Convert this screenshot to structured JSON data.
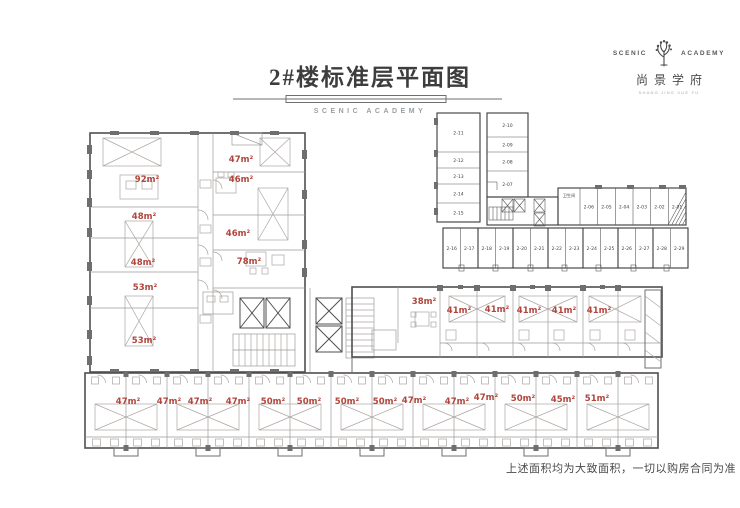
{
  "header": {
    "title": "2#楼标准层平面图",
    "subtitle": "SCENIC ACADEMY"
  },
  "logo": {
    "name_left": "SCENIC",
    "name_right": "ACADEMY",
    "icon": "tree-icon",
    "chinese_name": "尚景学府",
    "tagline": "SHANG JING XUE FU"
  },
  "plan": {
    "area_labels": [
      {
        "t": "92㎡",
        "x": 147,
        "y": 182
      },
      {
        "t": "47㎡",
        "x": 241,
        "y": 162
      },
      {
        "t": "46㎡",
        "x": 241,
        "y": 182
      },
      {
        "t": "48㎡",
        "x": 144,
        "y": 219
      },
      {
        "t": "46㎡",
        "x": 238,
        "y": 236
      },
      {
        "t": "48㎡",
        "x": 143,
        "y": 265
      },
      {
        "t": "78㎡",
        "x": 249,
        "y": 264
      },
      {
        "t": "53㎡",
        "x": 145,
        "y": 290
      },
      {
        "t": "53㎡",
        "x": 144,
        "y": 343
      },
      {
        "t": "38㎡",
        "x": 424,
        "y": 304
      },
      {
        "t": "41㎡",
        "x": 459,
        "y": 313
      },
      {
        "t": "41㎡",
        "x": 497,
        "y": 312
      },
      {
        "t": "41㎡",
        "x": 529,
        "y": 313
      },
      {
        "t": "41㎡",
        "x": 564,
        "y": 313
      },
      {
        "t": "41㎡",
        "x": 599,
        "y": 313
      },
      {
        "t": "47㎡",
        "x": 128,
        "y": 404
      },
      {
        "t": "47㎡",
        "x": 169,
        "y": 404
      },
      {
        "t": "47㎡",
        "x": 200,
        "y": 404
      },
      {
        "t": "47㎡",
        "x": 238,
        "y": 404
      },
      {
        "t": "50㎡",
        "x": 273,
        "y": 404
      },
      {
        "t": "50㎡",
        "x": 309,
        "y": 404
      },
      {
        "t": "50㎡",
        "x": 347,
        "y": 404
      },
      {
        "t": "50㎡",
        "x": 385,
        "y": 404
      },
      {
        "t": "47㎡",
        "x": 414,
        "y": 403
      },
      {
        "t": "47㎡",
        "x": 457,
        "y": 404
      },
      {
        "t": "47㎡",
        "x": 486,
        "y": 400
      },
      {
        "t": "50㎡",
        "x": 523,
        "y": 401
      },
      {
        "t": "45㎡",
        "x": 563,
        "y": 402
      },
      {
        "t": "51㎡",
        "x": 597,
        "y": 401
      }
    ]
  },
  "key_diagram": {
    "toilet_label": "卫生间",
    "left_column": [
      "2-11",
      "2-12",
      "2-13",
      "2-14",
      "2-15"
    ],
    "mid_column": [
      "2-10",
      "2-09",
      "2-08",
      "2-07"
    ],
    "right_row": [
      "2-06",
      "2-05",
      "2-04",
      "2-03",
      "2-02",
      "2-01"
    ],
    "bottom_row": [
      "2-16",
      "2-17",
      "2-18",
      "2-19",
      "2-20",
      "2-21",
      "2-22",
      "2-23",
      "2-24",
      "2-25",
      "2-26",
      "2-27",
      "2-28",
      "2-29"
    ]
  },
  "footer": {
    "disclaimer": "上述面积均为大致面积，一切以购房合同为准"
  },
  "colors": {
    "area_label": "#b0453c",
    "wall_dark": "#4f4f4f",
    "line_light": "#9a9a9a"
  }
}
